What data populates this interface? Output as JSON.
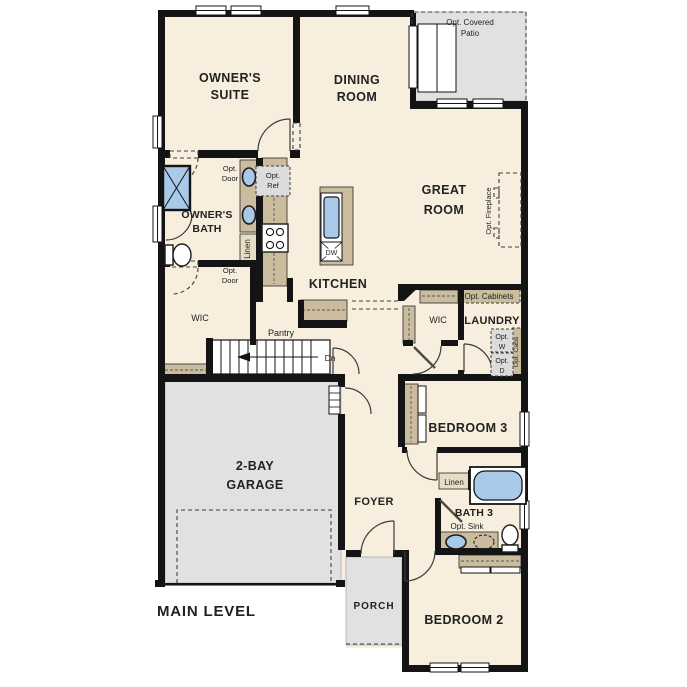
{
  "plan": {
    "level_title": "MAIN LEVEL",
    "colors": {
      "wall": "#141414",
      "floor": "#f7eedd",
      "area_gray": "#e1e1e1",
      "cabinet_tan": "#cbbc9e",
      "fixture_blue": "#a9c9e8",
      "text": "#222222"
    },
    "rooms": {
      "owners_suite": {
        "label": [
          "OWNER'S",
          "SUITE"
        ]
      },
      "dining_room": {
        "label": [
          "DINING",
          "ROOM"
        ]
      },
      "great_room": {
        "label": [
          "GREAT",
          "ROOM"
        ]
      },
      "owners_bath": {
        "label": [
          "OWNER'S",
          "BATH"
        ]
      },
      "kitchen": {
        "label": "KITCHEN"
      },
      "garage": {
        "label": [
          "2-BAY",
          "GARAGE"
        ]
      },
      "bedroom3": {
        "label": "BEDROOM 3"
      },
      "bedroom2": {
        "label": "BEDROOM 2"
      },
      "bath3": {
        "label": "BATH 3"
      },
      "laundry": {
        "label": "LAUNDRY"
      },
      "foyer": {
        "label": "FOYER"
      },
      "porch": {
        "label": "PORCH"
      },
      "wic_owner": {
        "label": "WIC"
      },
      "wic_hall": {
        "label": "WIC"
      },
      "pantry": {
        "label": "Pantry"
      }
    },
    "annotations": {
      "opt_covered_patio": [
        "Opt. Covered",
        "Patio"
      ],
      "opt_fireplace": "Opt. Fireplace",
      "opt_door_bath": [
        "Opt.",
        "Door"
      ],
      "opt_door_wic": [
        "Opt.",
        "Door"
      ],
      "opt_ref": [
        "Opt.",
        "Ref"
      ],
      "opt_cabinets": "Opt. Cabinets",
      "opt_washer": [
        "Opt.",
        "W"
      ],
      "opt_dryer": [
        "Opt.",
        "D"
      ],
      "opt_cabs": "Opt. Cabs",
      "opt_sink": "Opt. Sink",
      "linen_owner": "Linen",
      "linen_bath3": "Linen",
      "stairs_down": "Dn",
      "dishwasher": "DW"
    }
  }
}
